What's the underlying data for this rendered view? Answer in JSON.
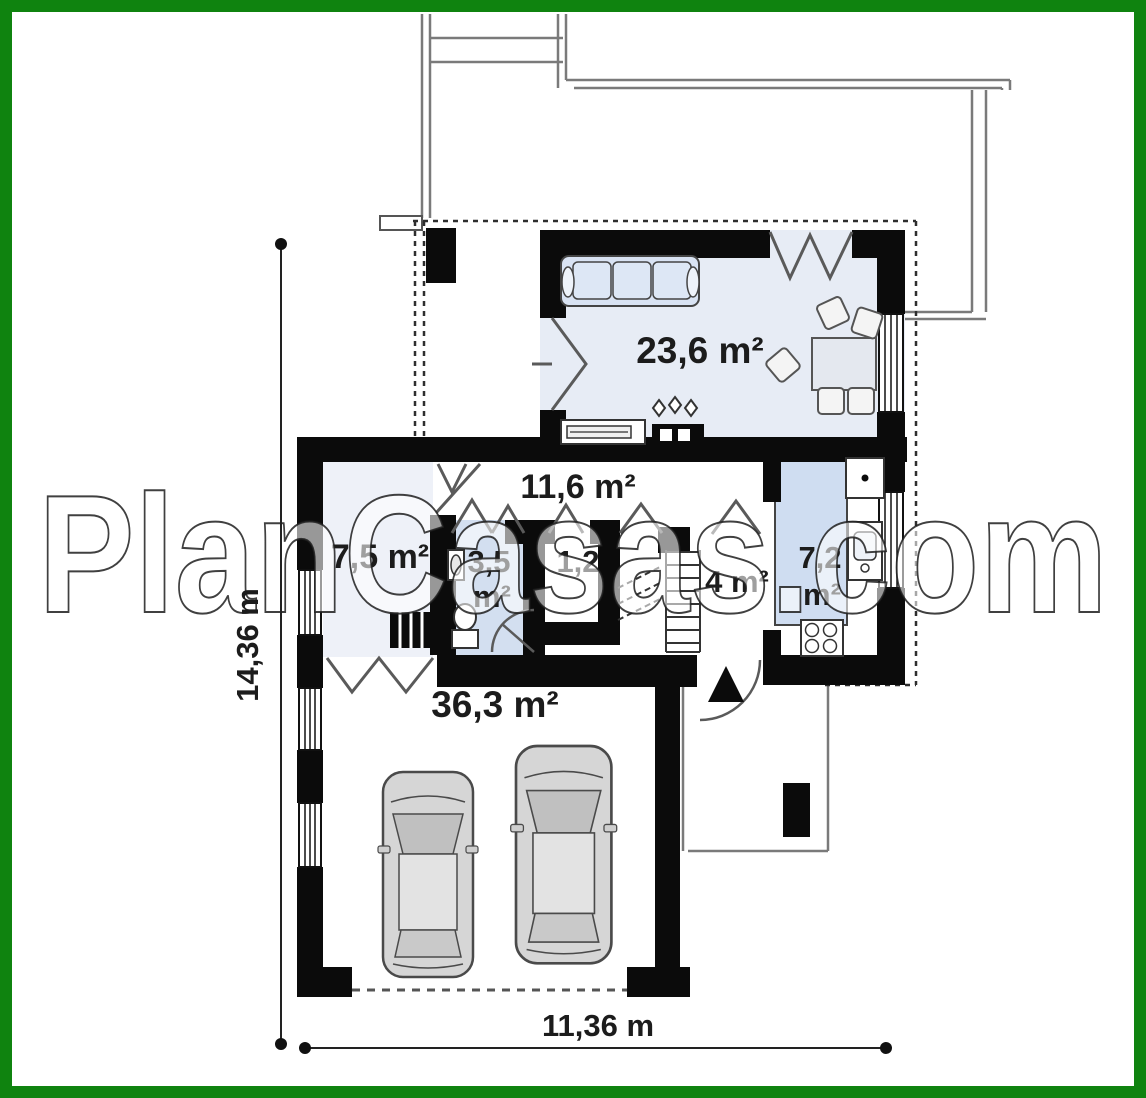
{
  "page": {
    "watermark": "PlanCasas.com",
    "type_note": "single floor plan drawing with green frame"
  },
  "colors": {
    "frame_green": "#0f830f",
    "wall_black": "#0b0b0b",
    "living_fill": "#e7ecf5",
    "bedroom_fill": "#eef1f8",
    "bath_fill": "#d3dff0",
    "counter_fill": "#cfddf1",
    "sofa_fill": "#d9e3f3",
    "car_gray": "#d6d6d6",
    "thin_line_gray": "#7a7a7a"
  },
  "rooms": {
    "living": {
      "label": "23,6 m²"
    },
    "hall": {
      "label": "11,6 m²"
    },
    "bedroom": {
      "label": "7,5 m²"
    },
    "bathroom": {
      "label_value": "3,5",
      "label_unit": "m²"
    },
    "closet": {
      "label": "1,2"
    },
    "vestibule": {
      "label": "4 m²"
    },
    "kitchen": {
      "label_value": "7,2",
      "label_unit": "m²"
    },
    "garage": {
      "label": "36,3 m²"
    }
  },
  "dimensions": {
    "vertical": "14,36 m",
    "horizontal": "11,36 m"
  }
}
